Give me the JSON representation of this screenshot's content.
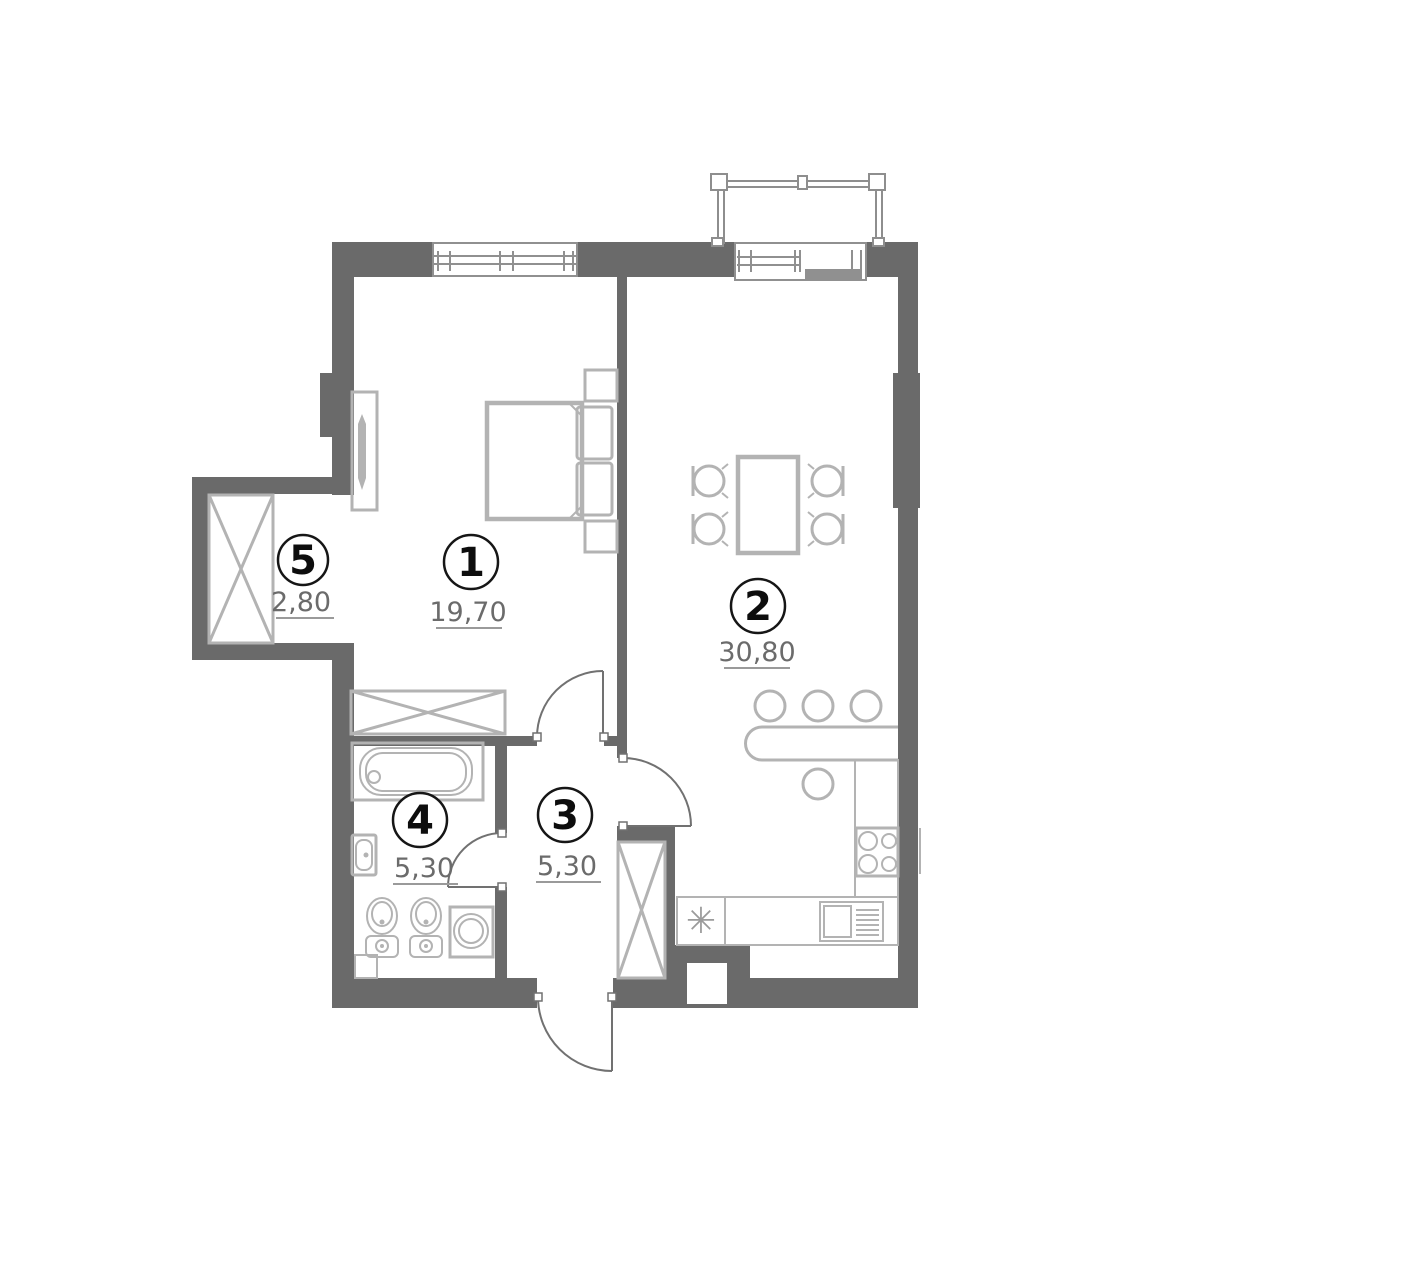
{
  "plan": {
    "rooms": [
      {
        "number": "1",
        "area": "19,70"
      },
      {
        "number": "2",
        "area": "30,80"
      },
      {
        "number": "3",
        "area": "5,30"
      },
      {
        "number": "4",
        "area": "5,30"
      },
      {
        "number": "5",
        "area": "2,80"
      }
    ],
    "symbols": {
      "kitchen_sink": "✳"
    }
  },
  "colors": {
    "wall": "#6a6a6a",
    "furniture": "#b3b3b3",
    "door": "#717171",
    "window": "#909090",
    "label_text": "#6b6b6b"
  }
}
